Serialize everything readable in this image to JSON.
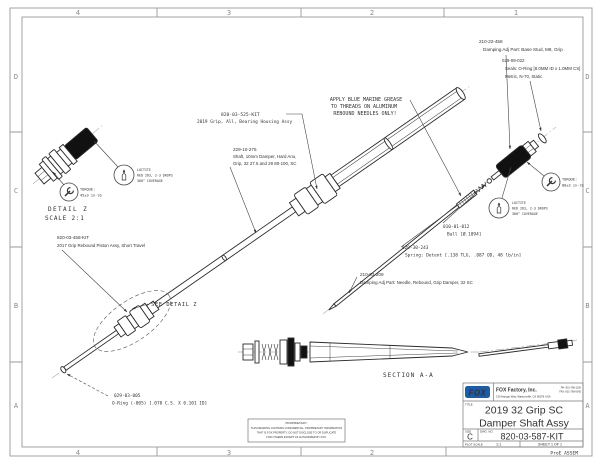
{
  "sheet": {
    "zones_top": [
      "4",
      "3",
      "2",
      "1"
    ],
    "zones_bottom": [
      "4",
      "3",
      "2"
    ],
    "zones_right": [
      "D",
      "C",
      "B",
      "A"
    ],
    "zones_left": [
      "D",
      "C",
      "B",
      "A"
    ],
    "plot_note": "ProE ASSEM"
  },
  "notes": {
    "grease_l1": "APPLY BLUE MARINE GREASE",
    "grease_l2": "TO THREADS ON ALUMINUM",
    "grease_l3": "REBOUND NEEDLES ONLY!"
  },
  "callouts": {
    "base_stud_pn": "210-22-458",
    "base_stud_desc": "Damping Adj Part: Base Stud, M8, Grip",
    "seal_pn": "029-08-022",
    "seal_desc1": "Seals: O-Ring [8.0MM ID x 1.0MM CS]",
    "seal_desc2": "Metric, N-70, Static",
    "housing_pn": "820-03-525-KIT",
    "housing_desc": "2019 Grip, All, Bearing Housing Assy",
    "shaft_pn": "229-10-275",
    "shaft_desc1": "Shaft, 10mm Damper, Hard Ano,",
    "shaft_desc2": "Grip, 32 27.5 and 29 80-100, SC",
    "piston_pn": "820-03-458-KIT",
    "piston_desc": "2017 Grip Rebound Piston Assy, Short Travel",
    "ball_pn": "010-01-012",
    "ball_desc": "Ball [Ø.1094]",
    "spring_pn": "029-30-243",
    "spring_desc": "Spring: Detent [.138 TLG, .087 OD, 48 lb/in]",
    "needle_pn": "210-03-209",
    "needle_desc": "Damping Adj Part: Needle, Rebound, Grip Damper, 32 SC",
    "oring_pn": "029-03-005",
    "oring_desc": "O-Ring (-005) [.070 C.S. X 0.101 ID]",
    "see_detail": "SEE DETAIL Z"
  },
  "balloons": {
    "torque_detail_l1": "TORQUE:",
    "torque_detail_l2": "45±3 in-lb",
    "torque_stud_l1": "TORQUE:",
    "torque_stud_l2": "80±3 in-lb",
    "loctite_l1": "LOCTITE",
    "loctite_l2": "RED 263, 2-3 DROPS",
    "loctite_l3": "360° COVERAGE"
  },
  "views": {
    "detail_name": "DETAIL Z",
    "detail_scale": "SCALE 2:1",
    "section_name": "SECTION A-A"
  },
  "title_block": {
    "logo": "FOX",
    "company": "FOX Factory, Inc.",
    "address": "130 Hangar Way, Watsonville, CA 95076 USA",
    "phone": "PH: 831-768-1100",
    "fax": "FAX: 831-768-9342",
    "title_label": "TITLE",
    "title_line1": "2019 32 Grip SC",
    "title_line2": "Damper Shaft Assy",
    "size_label": "SIZE",
    "size": "C",
    "dwg_label": "DWG. NO.",
    "dwg_no": "820-03-587-KIT",
    "plot_scale_label": "PLOT SCALE",
    "plot_scale": "1:1",
    "sheet_label": "SHEET 1 OF 1"
  },
  "proprietary": {
    "l1": "PROPRIETARY:",
    "l2": "THIS DRAWING CONTAINS CONFIDENTIAL, PROPRIETARY INFORMATION",
    "l3": "THAT IS FOX PROPERTY. DO NOT DISCLOSE TO OR DUPLICATE",
    "l4": "FOR OTHERS EXCEPT AS AUTHORIZED BY FOX."
  },
  "colors": {
    "logo_blue": "#1b5ca8"
  }
}
